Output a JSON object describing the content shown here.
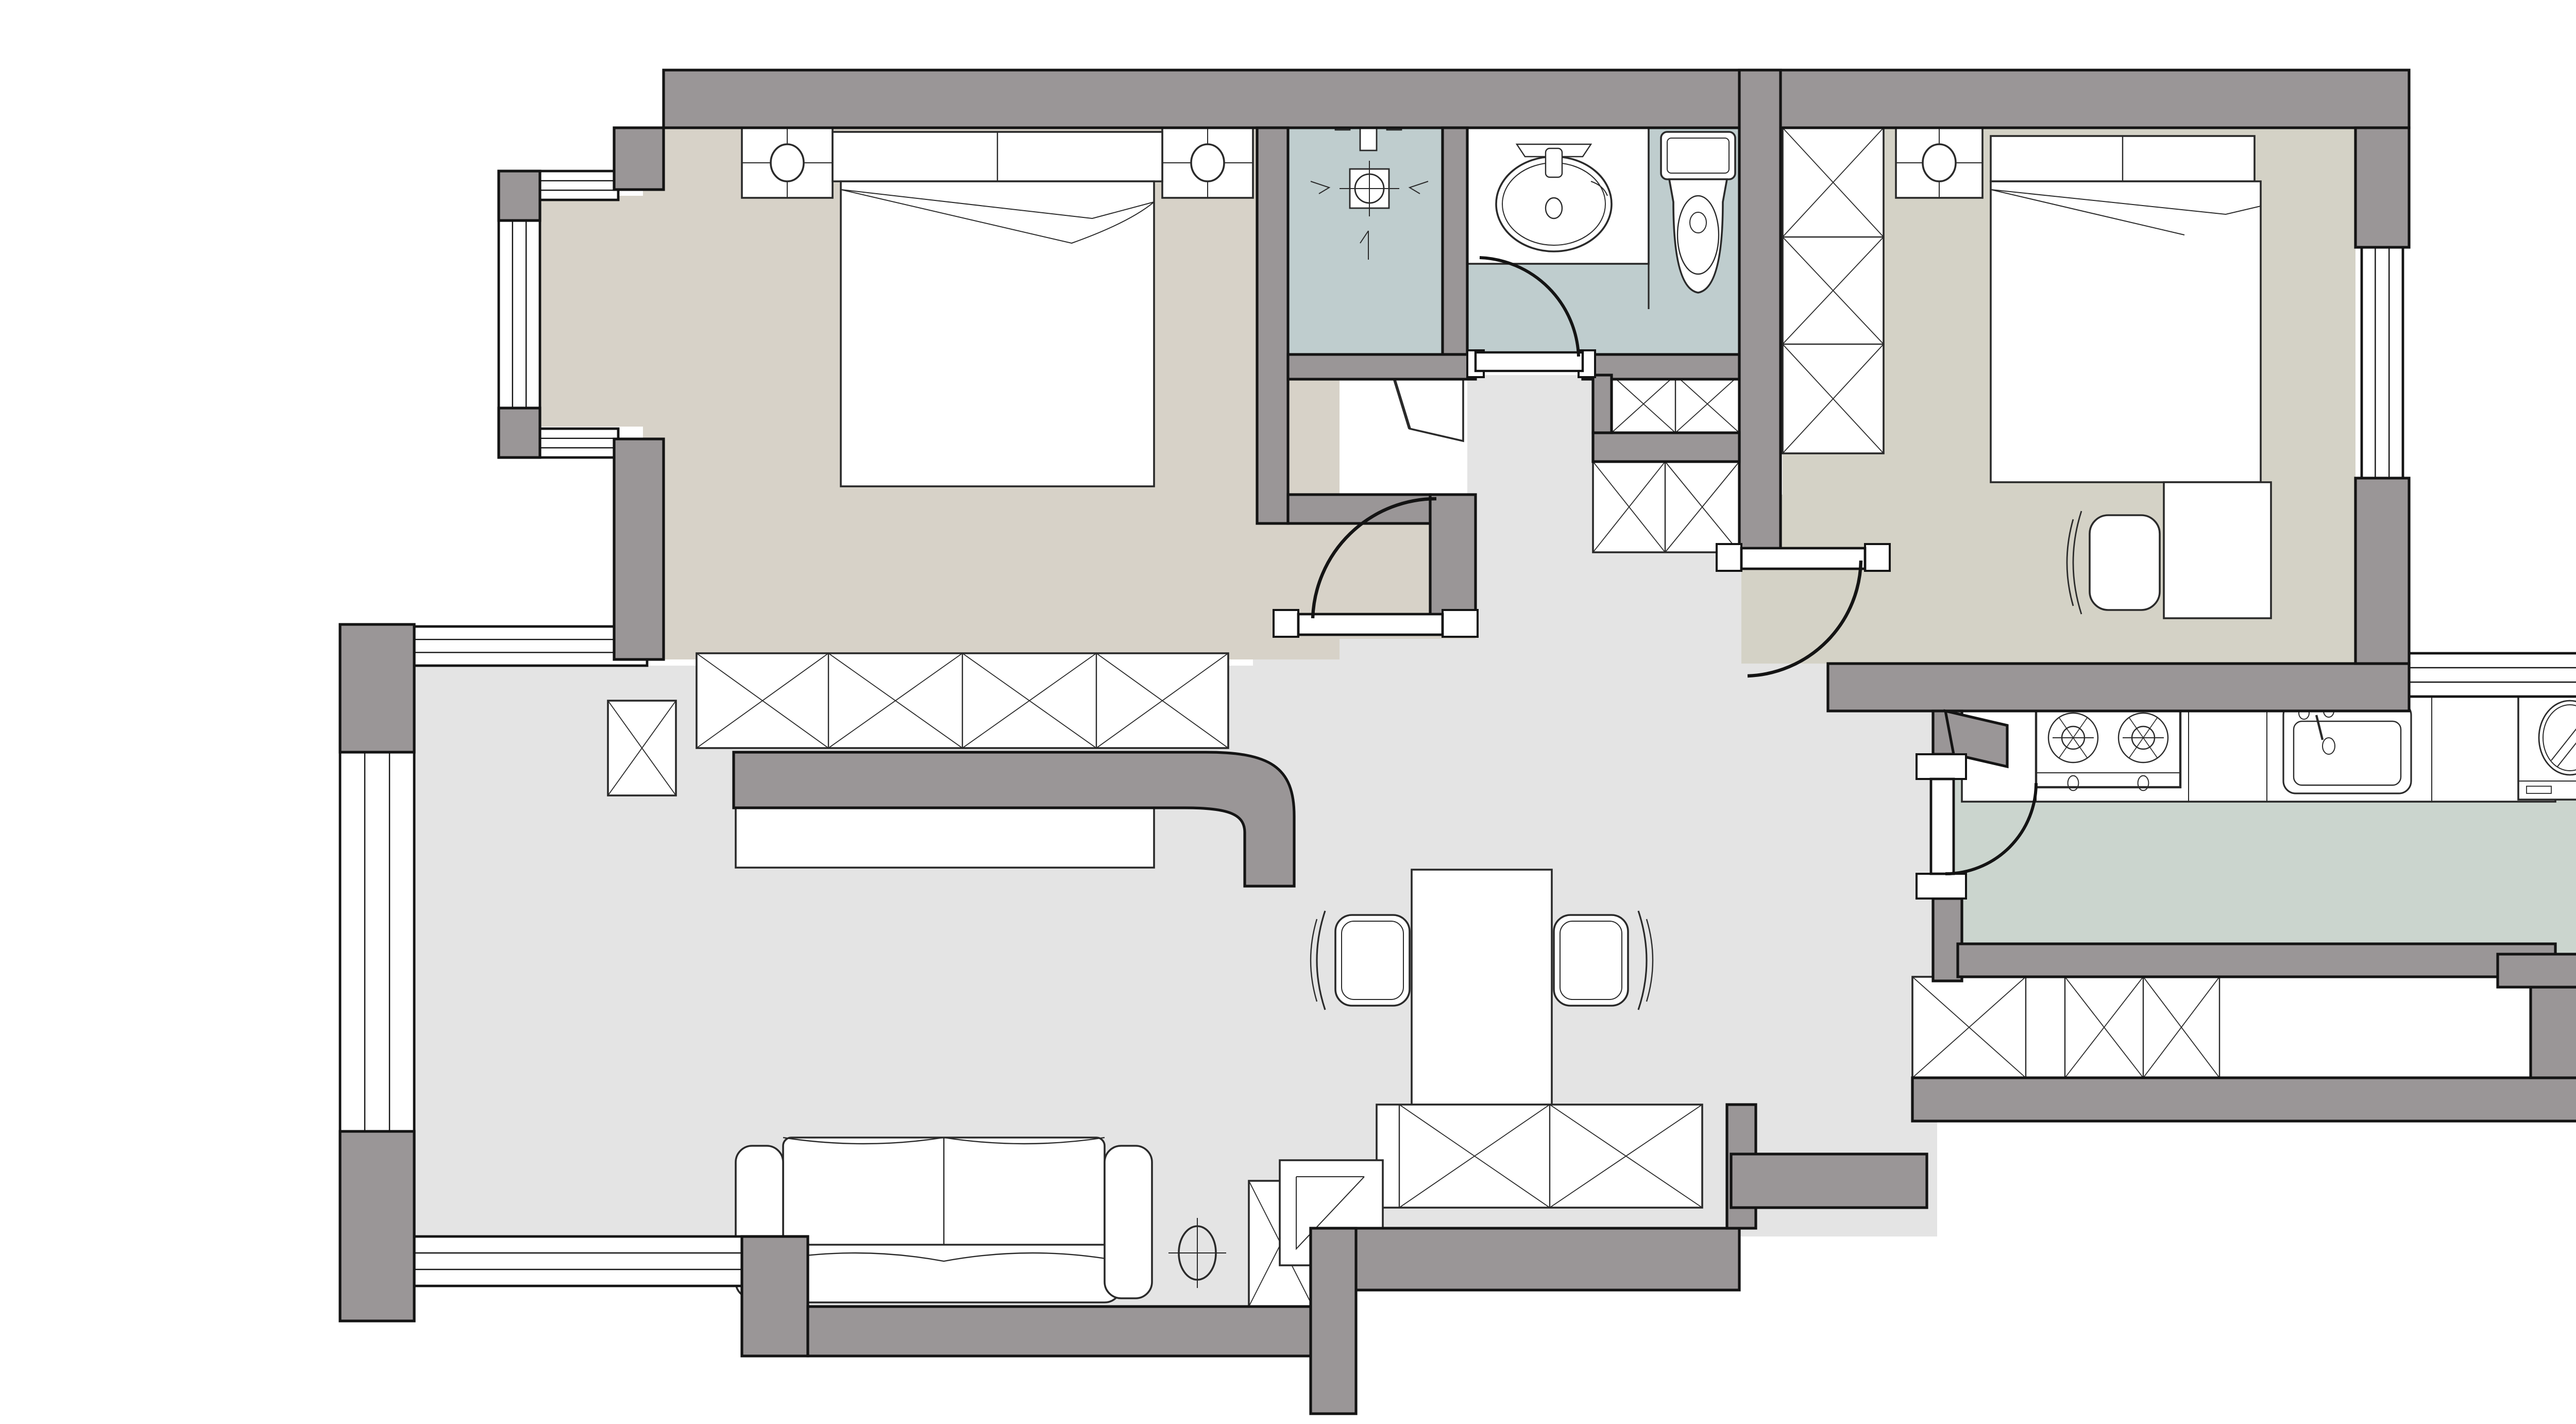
{
  "document": {
    "type": "apartment-floor-plan",
    "title": "",
    "visible_text": []
  },
  "palette": {
    "background": "#ffffff",
    "wall_fill": "#9a9697",
    "wall_outline": "#141414",
    "bedroom_floor": "#d7d2c8",
    "bedroom2_floor": "#d4d2c6",
    "bathroom_floor": "#bfcdce",
    "hall_living_floor": "#e4e4e4",
    "kitchen_balcony_floor": "#cbd5ce",
    "furniture_fill": "#ffffff",
    "furniture_line": "#2a2a2a"
  },
  "rooms": [
    {
      "name": "master-bedroom",
      "floor_color": "#d7d2c8",
      "features": [
        "double-bed",
        "two-nightstands-with-lamps",
        "headboard",
        "wardrobe-4-sections",
        "bay-window-left"
      ]
    },
    {
      "name": "shower-room",
      "floor_color": "#bfcdce",
      "features": [
        "shower-mixer",
        "floor-drain",
        "slope-arrows"
      ]
    },
    {
      "name": "bathroom",
      "floor_color": "#bfcdce",
      "features": [
        "vanity-counter",
        "oval-sink",
        "toilet",
        "swing-door"
      ]
    },
    {
      "name": "bedroom-2",
      "floor_color": "#d4d2c6",
      "features": [
        "wardrobe-3-sections",
        "nightstand-with-lamp",
        "double-bed",
        "desk",
        "chair",
        "window-right",
        "swing-door"
      ]
    },
    {
      "name": "hall",
      "floor_color": "#e4e4e4",
      "features": [
        "storage-cabinets",
        "door-openings"
      ]
    },
    {
      "name": "kitchen",
      "floor_color": "#cbd5ce",
      "features": [
        "counter",
        "gas-hob-2-burners",
        "kitchen-sink",
        "swing-door",
        "base-cabinets"
      ]
    },
    {
      "name": "laundry-balcony",
      "floor_color": "#cbd5ce",
      "features": [
        "washing-machine",
        "washing-machine",
        "wrap-around-windows"
      ]
    },
    {
      "name": "living-dining",
      "floor_color": "#e4e4e4",
      "features": [
        "sofa-2-seat",
        "floor-lamp",
        "tv-cabinet",
        "tv",
        "dining-table",
        "two-dining-chairs",
        "sideboard",
        "entry-bench",
        "bay-window-left",
        "windows-bottom"
      ]
    }
  ],
  "icons": [
    {
      "name": "shower-mixer-icon"
    },
    {
      "name": "floor-drain-icon"
    },
    {
      "name": "sink-icon"
    },
    {
      "name": "toilet-icon"
    },
    {
      "name": "gas-hob-icon"
    },
    {
      "name": "kitchen-sink-icon"
    },
    {
      "name": "washing-machine-icon"
    },
    {
      "name": "lamp-icon"
    },
    {
      "name": "door-swing-arc"
    },
    {
      "name": "wardrobe-x-symbol"
    },
    {
      "name": "window-symbol"
    }
  ],
  "doors": [
    {
      "name": "master-bedroom-door",
      "type": "swing"
    },
    {
      "name": "bedroom-2-door",
      "type": "swing"
    },
    {
      "name": "bathroom-door",
      "type": "swing"
    },
    {
      "name": "kitchen-door",
      "type": "swing"
    }
  ],
  "windows": [
    {
      "name": "master-bay-window",
      "panes": 3
    },
    {
      "name": "living-bay-window",
      "panes": 3
    },
    {
      "name": "living-northwest-window",
      "panes": 3
    },
    {
      "name": "living-south-window",
      "panes": 3
    },
    {
      "name": "bedroom2-east-window",
      "panes": 3
    },
    {
      "name": "balcony-wrap-windows",
      "panes": 3
    }
  ]
}
